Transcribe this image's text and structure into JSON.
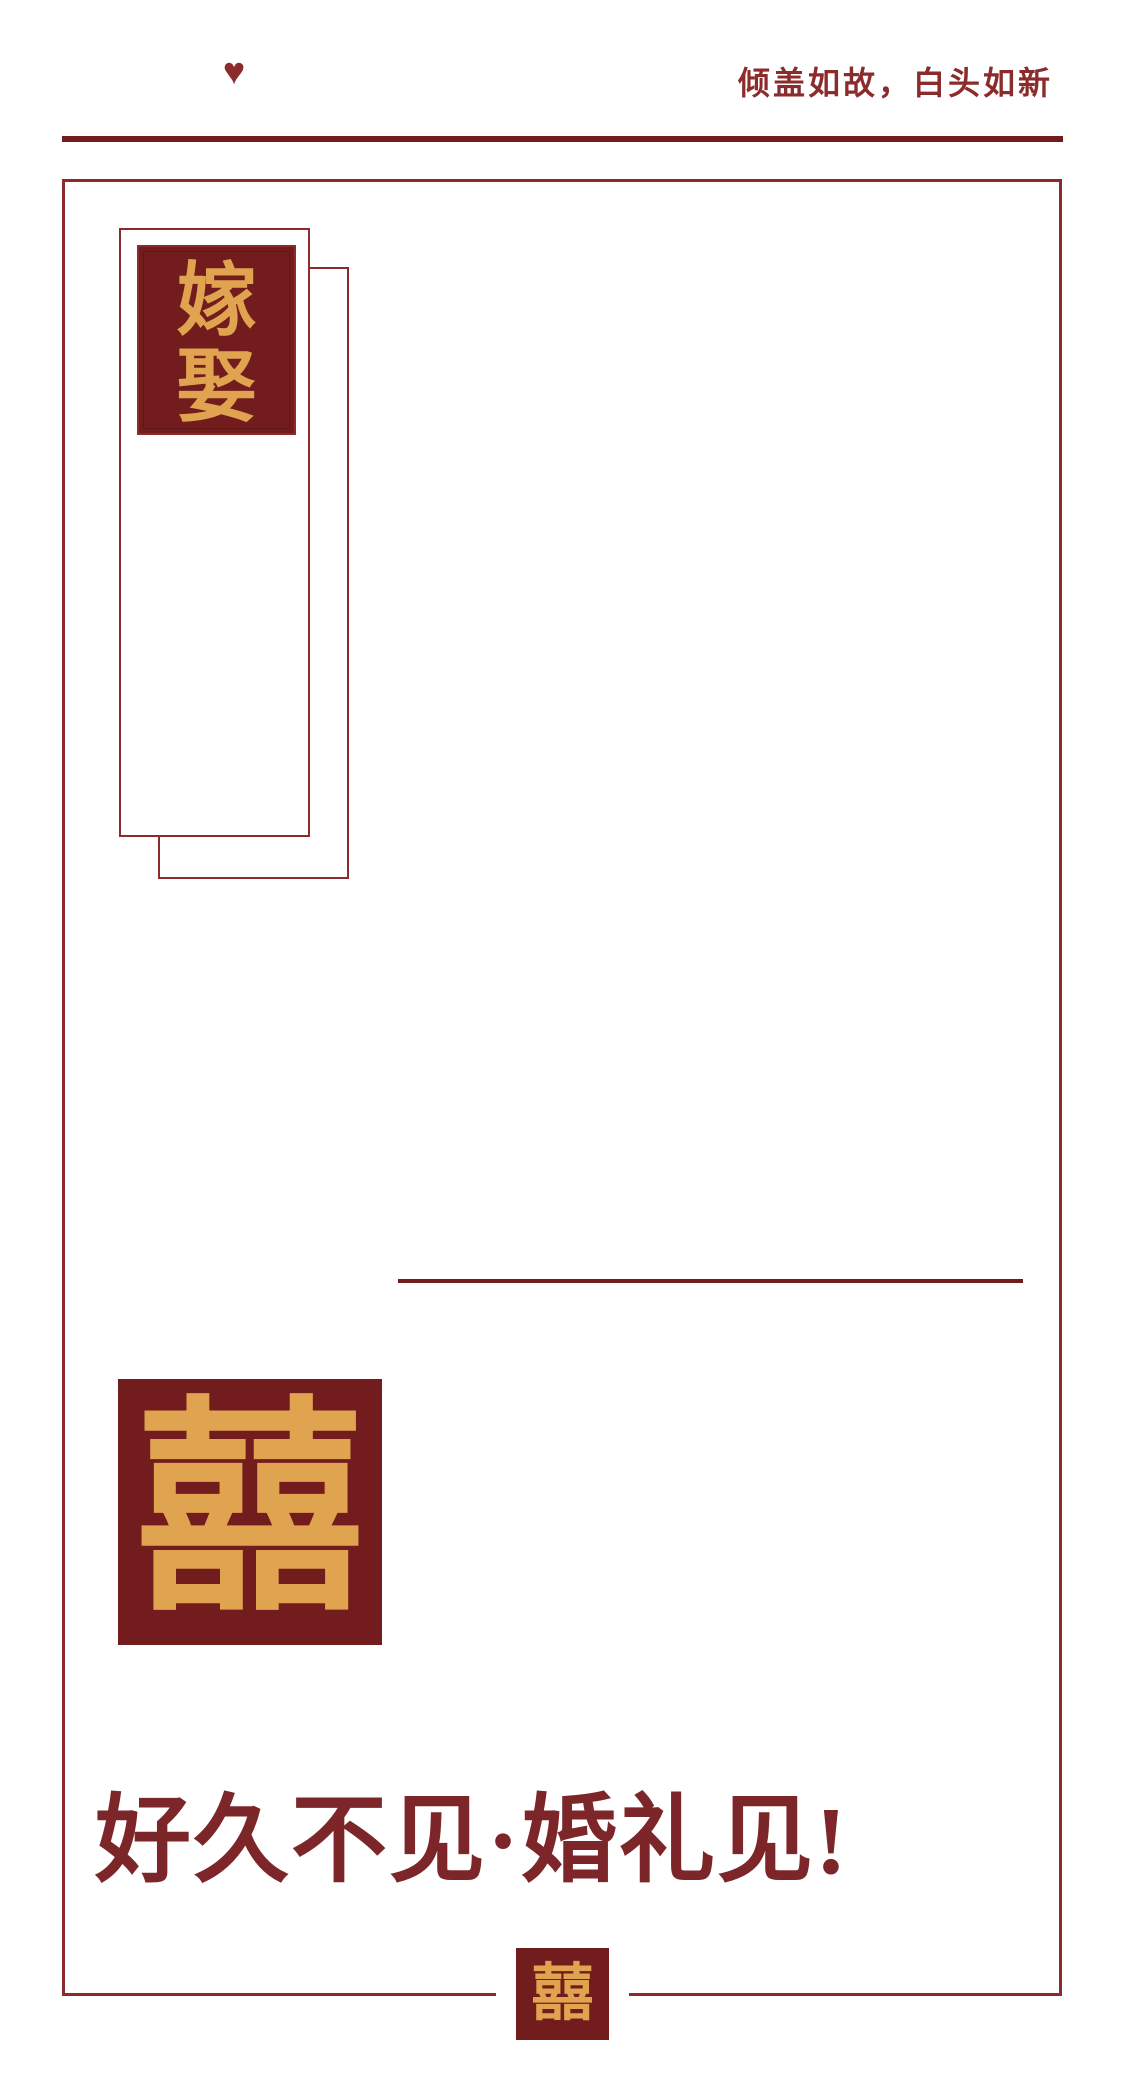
{
  "colors": {
    "deep_red": "#731c1d",
    "border_red": "#8c2b2b",
    "headline_red": "#7d2629",
    "gold": "#e0a350",
    "background": "#ffffff"
  },
  "header": {
    "heart_icon": "♥",
    "tagline": "倾盖如故，白头如新"
  },
  "stamp_card": {
    "chars": [
      "嫁",
      "娶"
    ]
  },
  "seals": {
    "double_happiness_large": "囍",
    "double_happiness_small": "囍"
  },
  "headline": {
    "text": "好久不见·婚礼见!"
  }
}
